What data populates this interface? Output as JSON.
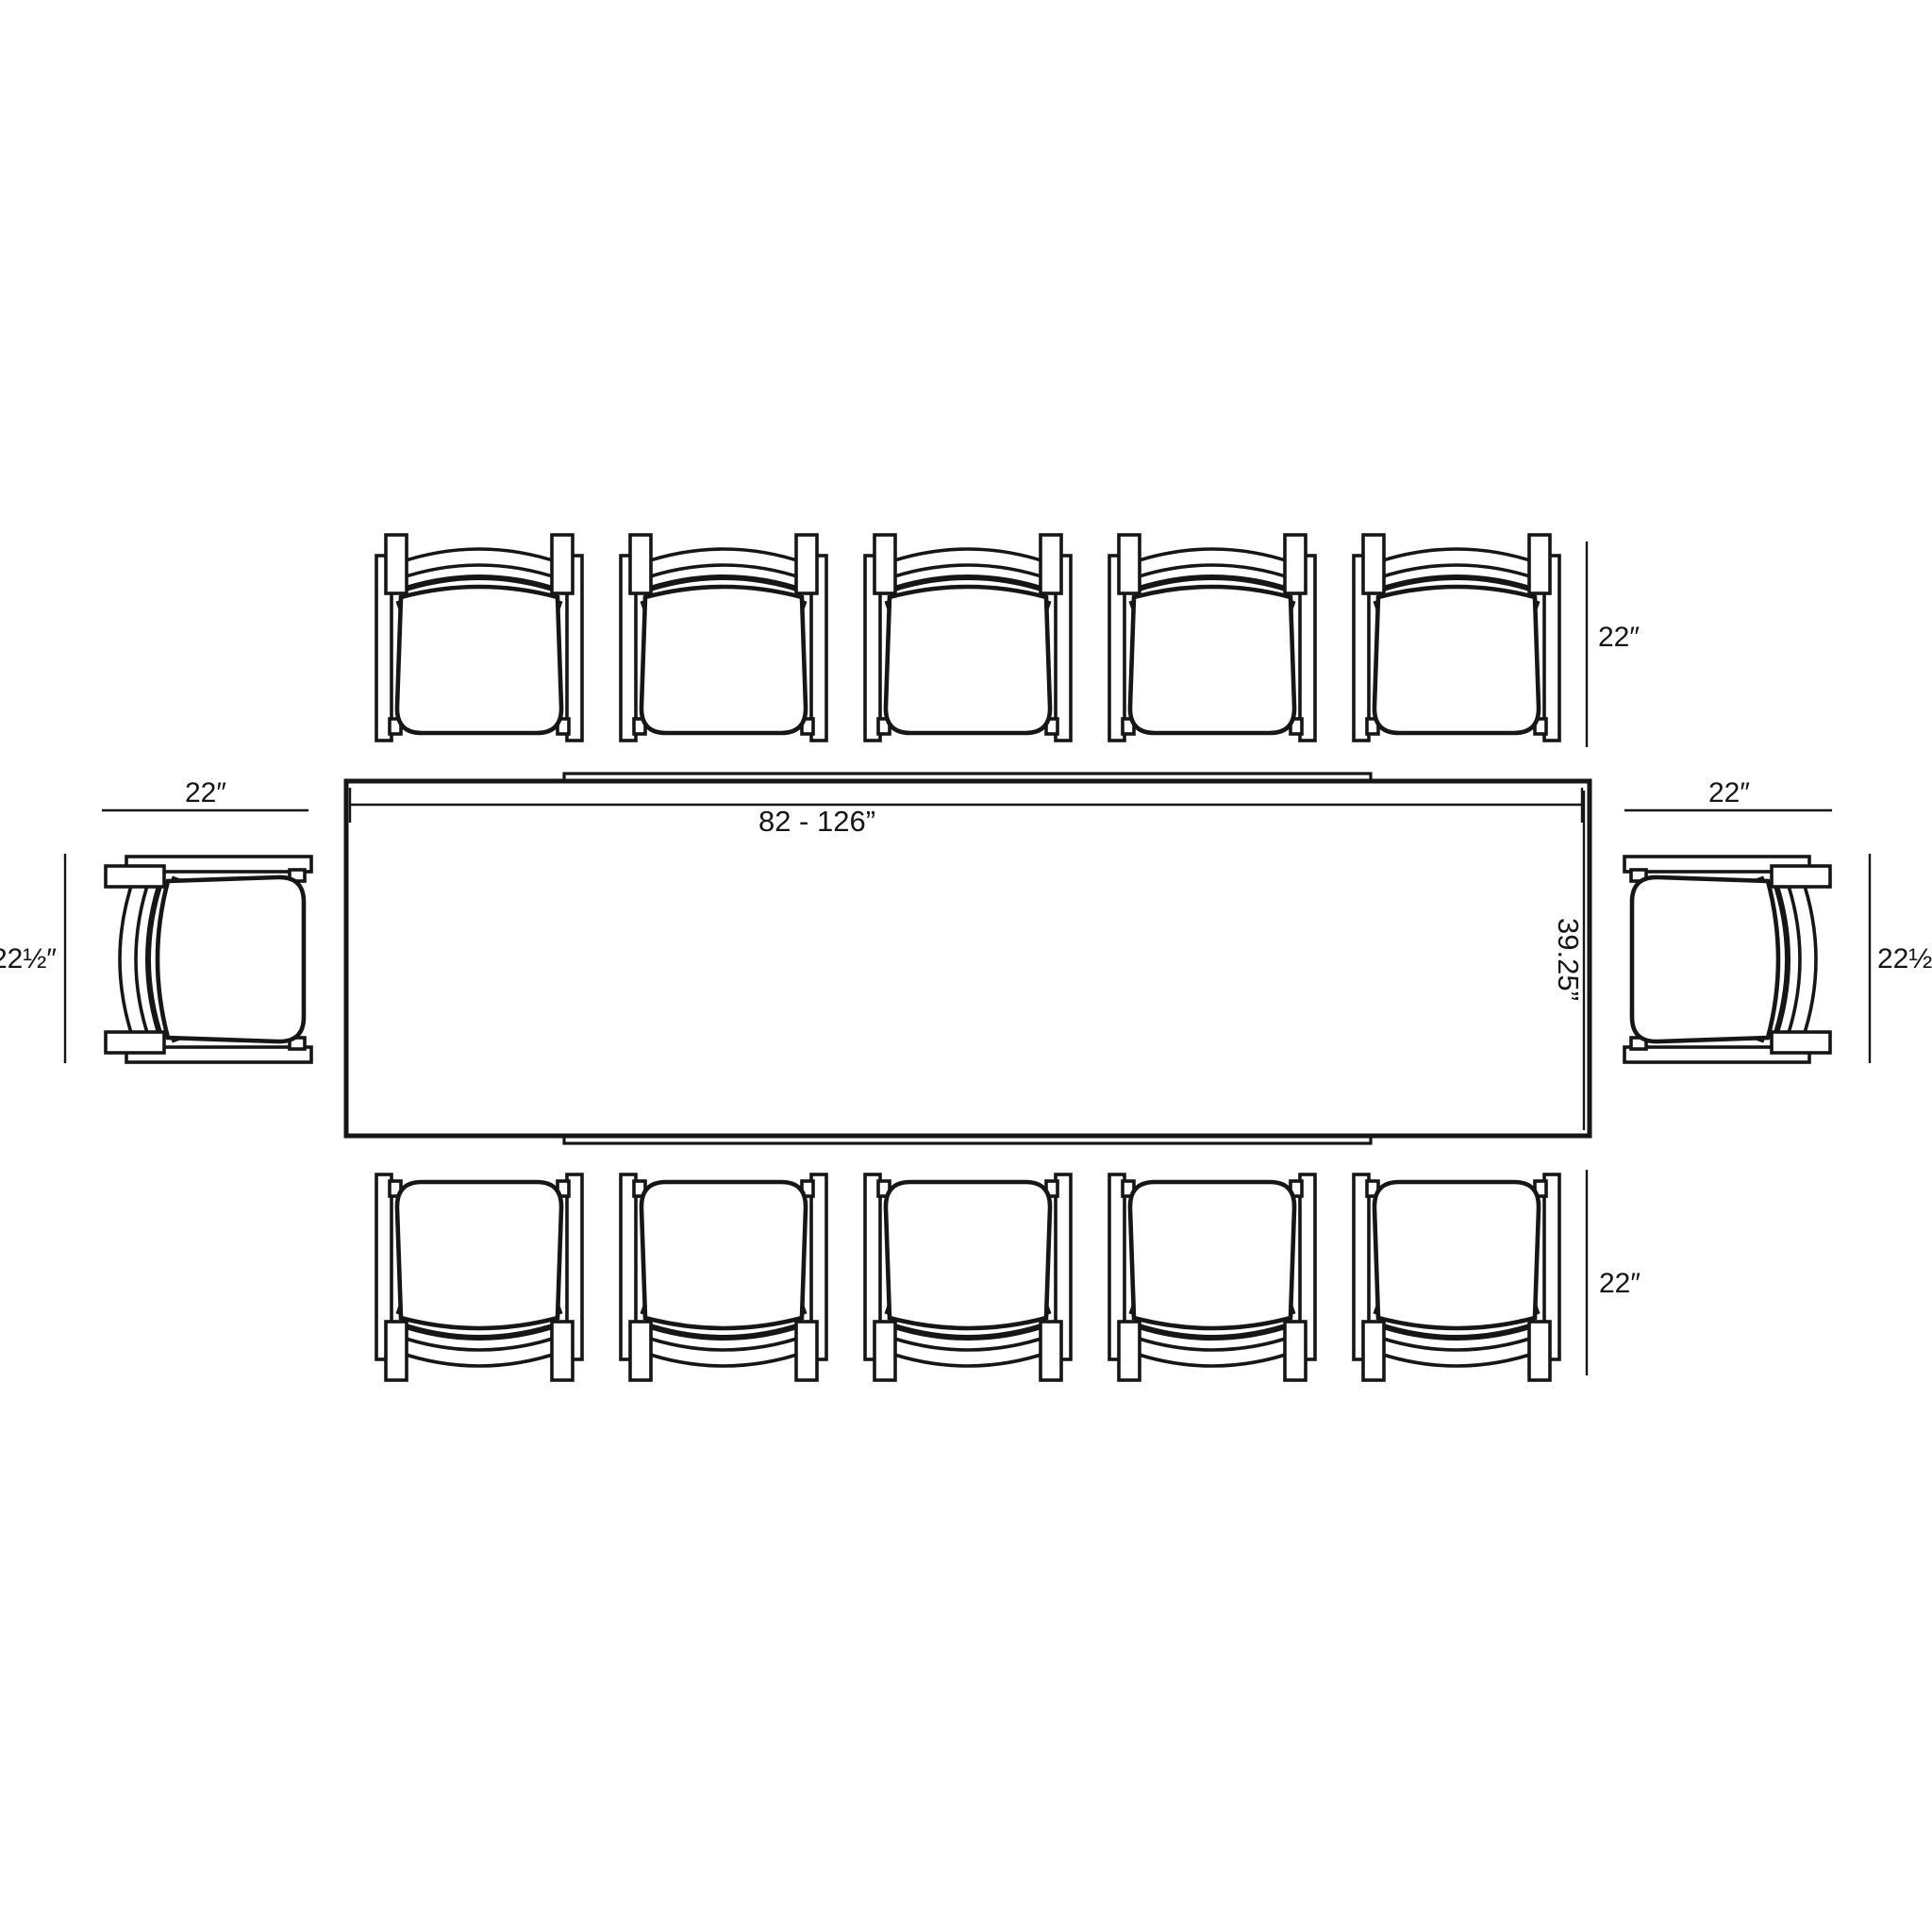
{
  "diagram": {
    "type": "furniture-plan-top-view",
    "subject": "extension dining table with twelve chairs",
    "colors": {
      "line": "#161616",
      "background": "#ffffff"
    }
  },
  "table": {
    "length_label": "82 - 126”",
    "width_label": "39.25”"
  },
  "chairs": {
    "top_row_count": 5,
    "bottom_row_count": 5,
    "end_count": 2,
    "total": 12,
    "top_row_depth_label": "22″",
    "bottom_row_depth_label": "22″",
    "end_left_top_label": "22″",
    "end_right_top_label": "22″",
    "end_left_side_label": "22½″",
    "end_right_side_label": "22½″"
  }
}
